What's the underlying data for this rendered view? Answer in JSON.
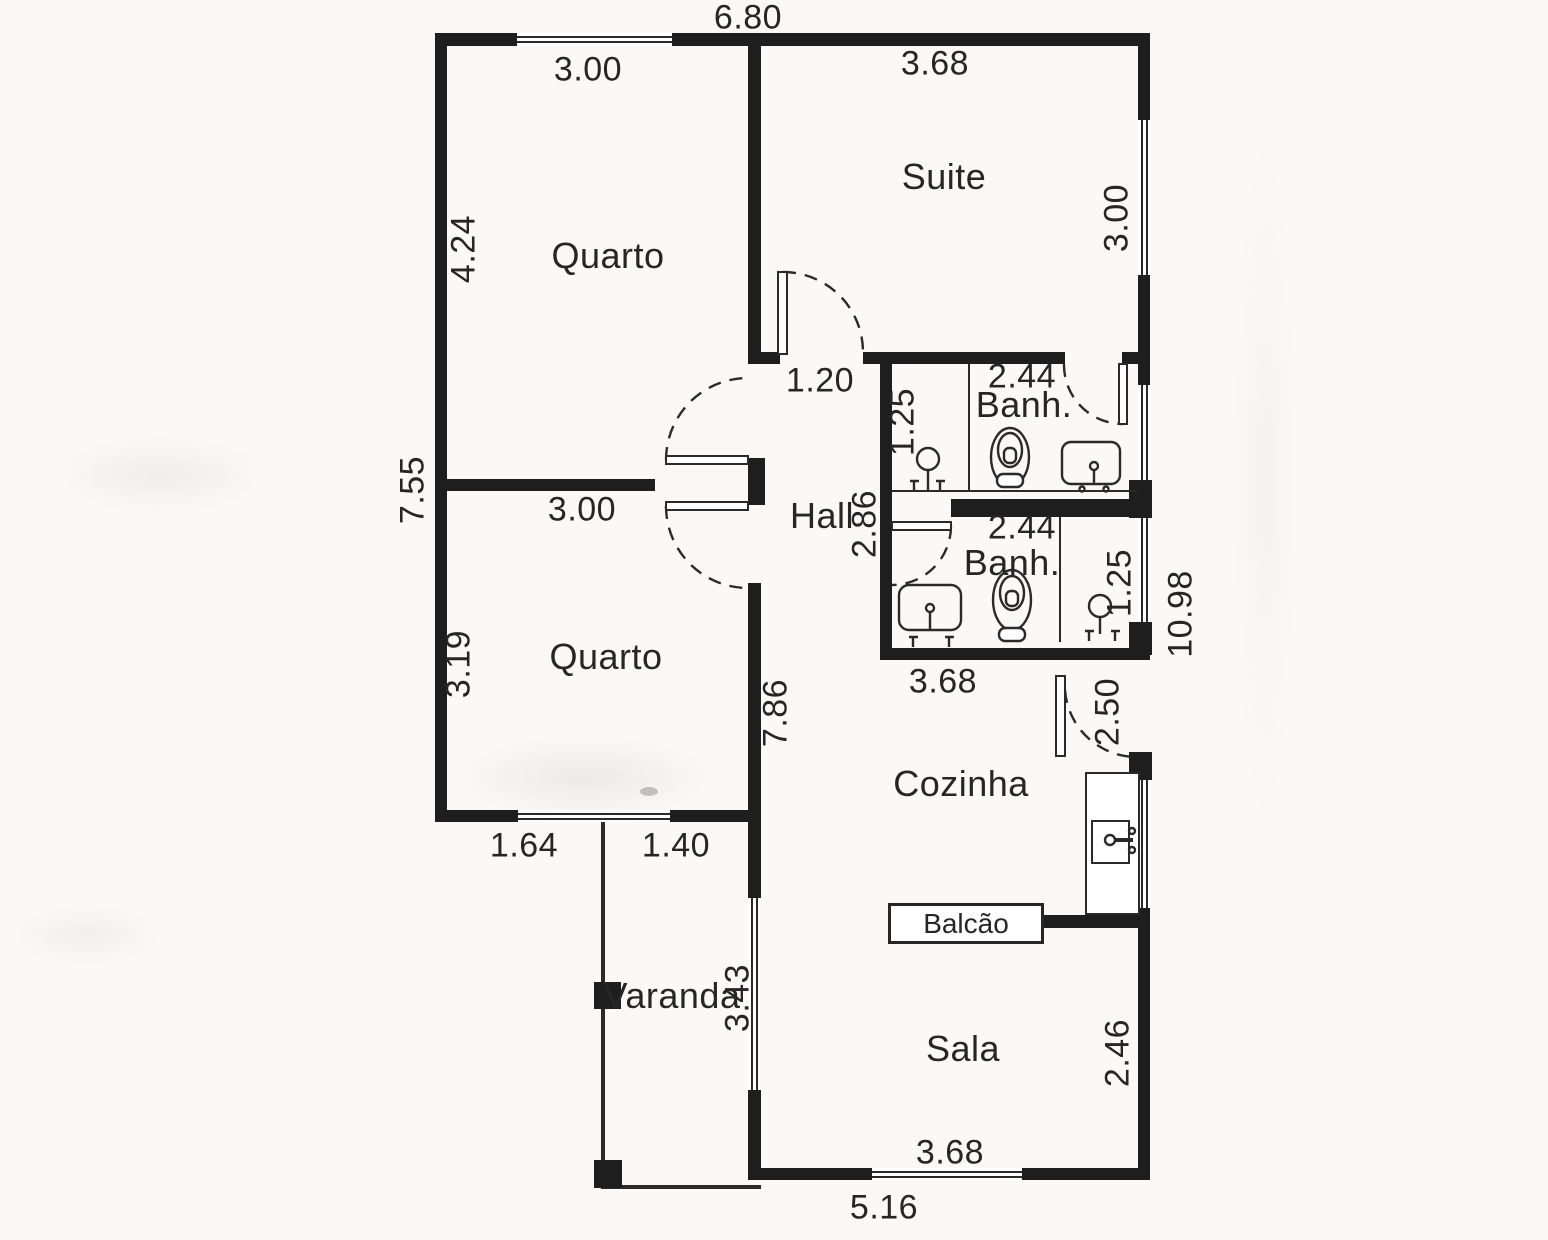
{
  "document": {
    "type": "residential floor plan (scanned)"
  },
  "colors": {
    "wall": "#1e1e1e",
    "line": "#2a2a2a",
    "text": "#262626",
    "paper": "#faf9f7"
  },
  "overall_dims": {
    "top_width": "6.80",
    "left_height": "7.55",
    "right_height": "10.98",
    "bottom_width": "5.16"
  },
  "rooms": {
    "quarto1": {
      "name": "Quarto",
      "width": "3.00",
      "height": "4.24"
    },
    "suite": {
      "name": "Suite",
      "width": "3.68",
      "side_height": "3.00"
    },
    "hall": {
      "name": "Hall",
      "entry_width": "1.20",
      "height": "2.86"
    },
    "banh1": {
      "name": "Banh.",
      "width": "2.44",
      "depth": "1.25"
    },
    "banh2": {
      "name": "Banh.",
      "width": "2.44",
      "depth": "1.25",
      "outer_width": "3.68"
    },
    "quarto2": {
      "name": "Quarto",
      "width": "3.00",
      "height": "3.19",
      "side_wall": "7.86",
      "bottom_seg_left": "1.64",
      "bottom_seg_right": "1.40"
    },
    "cozinha": {
      "name": "Cozinha",
      "door_span": "2.50"
    },
    "balcao": {
      "name": "Balcão"
    },
    "varanda": {
      "name": "Varanda",
      "height": "3.43"
    },
    "sala": {
      "name": "Sala",
      "side_height": "2.46",
      "bottom_width": "3.68"
    }
  },
  "fixtures": {
    "banh1": [
      "shower-icon",
      "toilet-icon",
      "sink-icon"
    ],
    "banh2": [
      "sink-icon",
      "toilet-icon",
      "shower-icon"
    ],
    "cozinha": [
      "kitchen-counter",
      "kitchen-sink-icon"
    ]
  }
}
